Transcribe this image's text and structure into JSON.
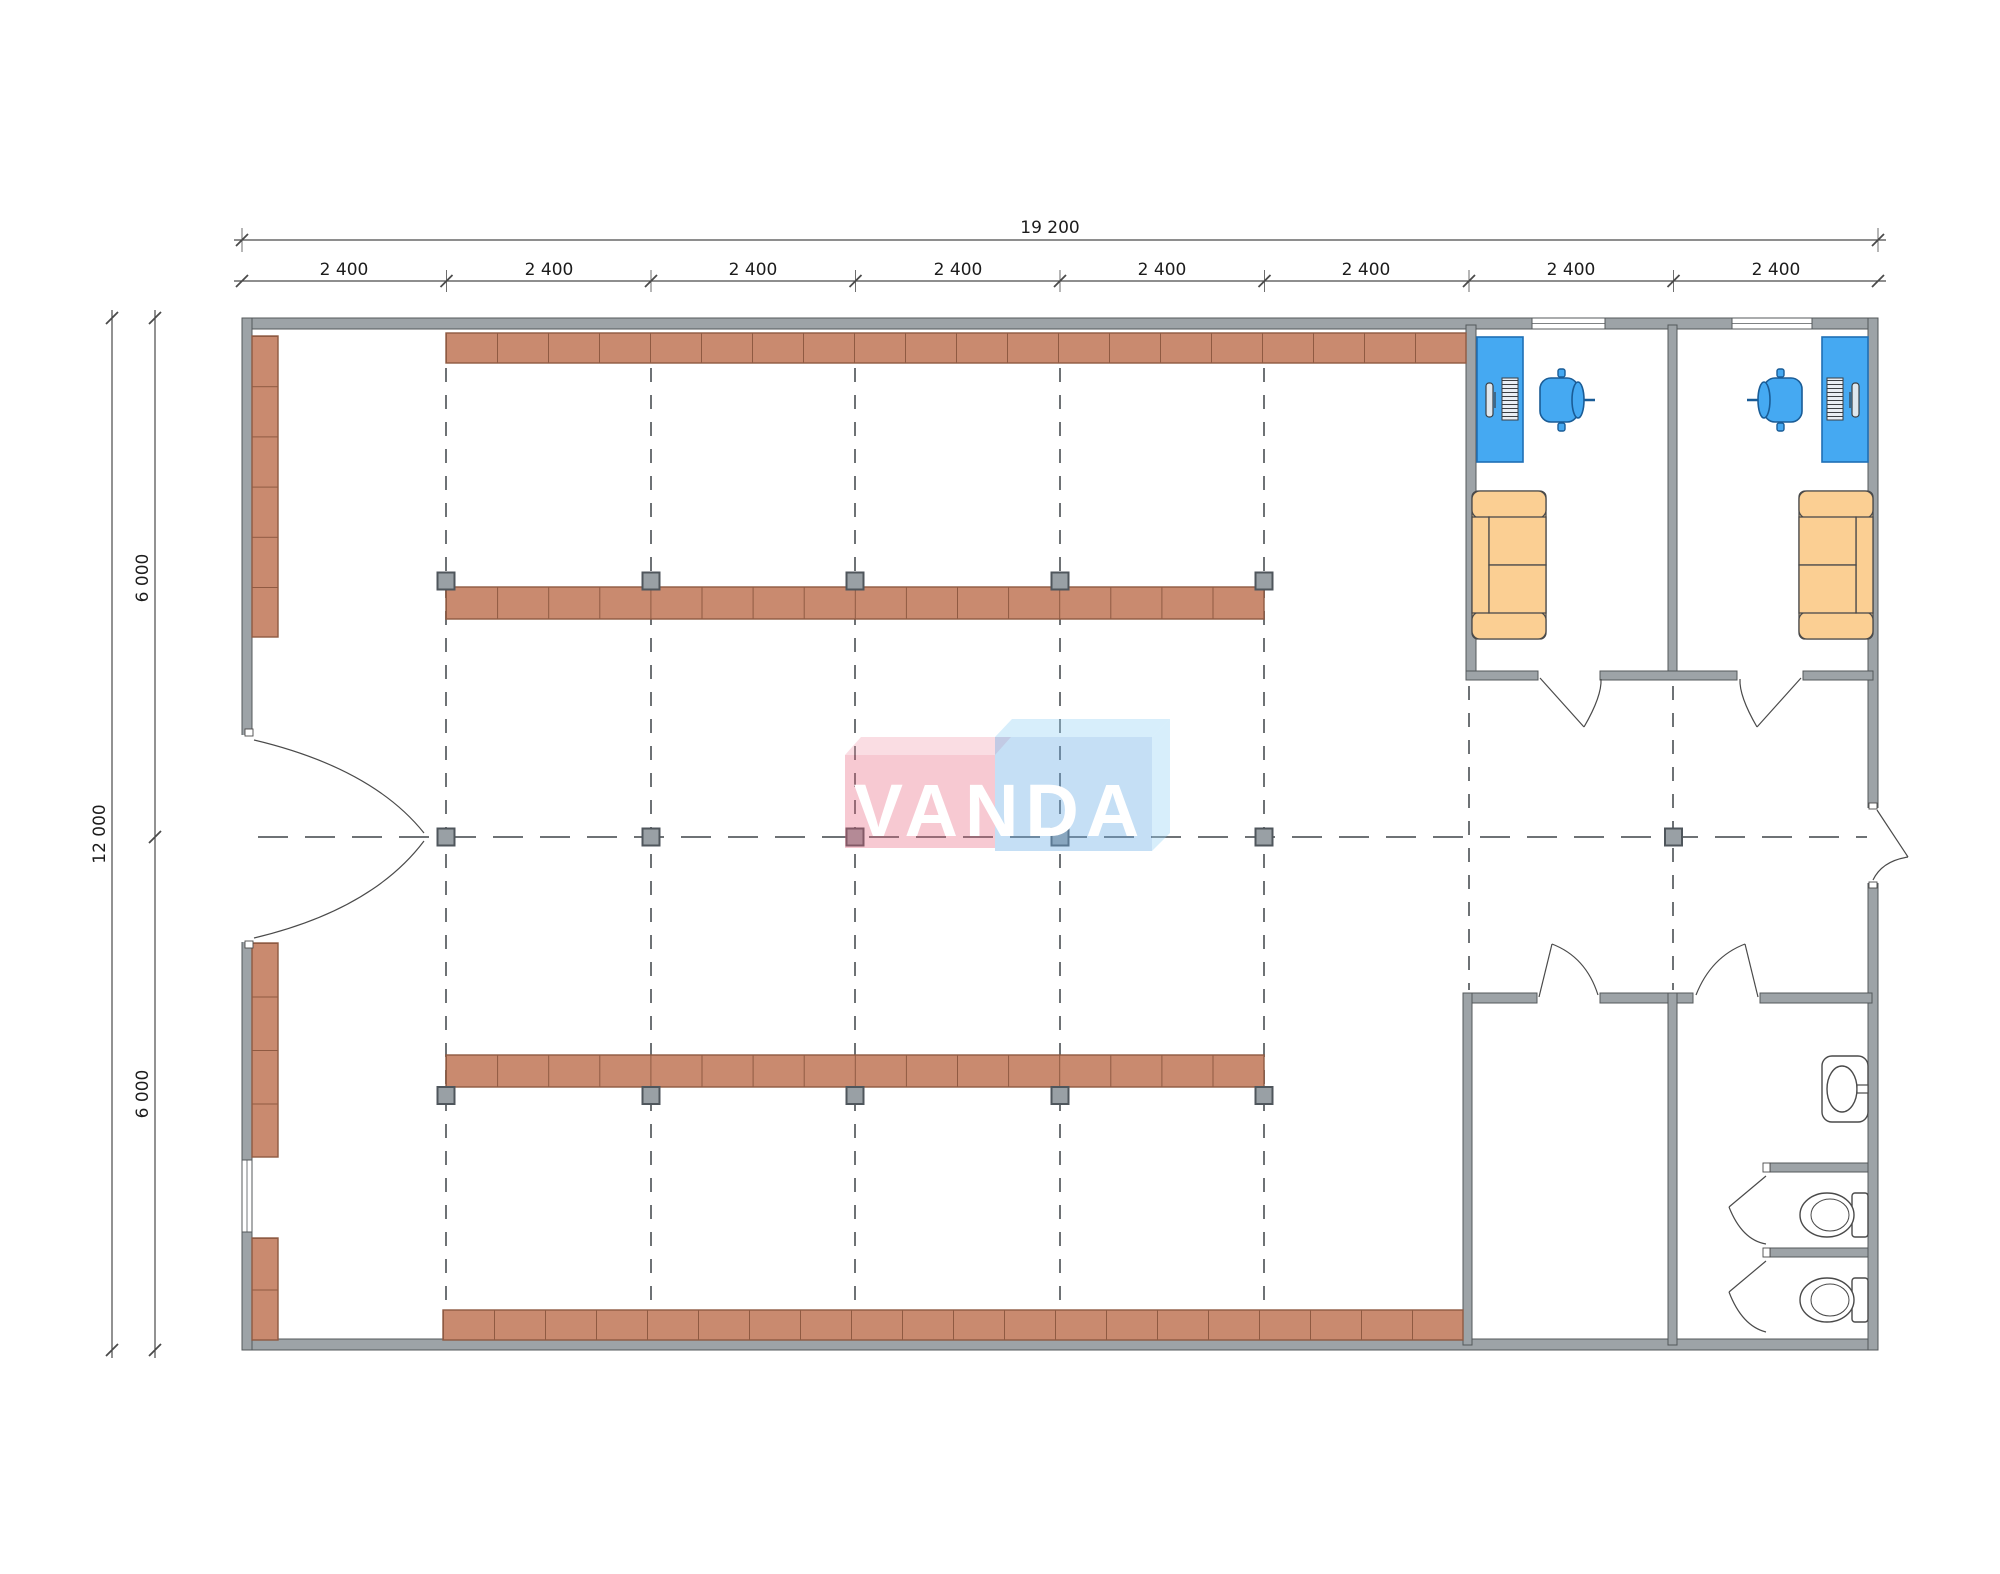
{
  "drawing": {
    "type": "floor-plan",
    "units": "mm"
  },
  "dimensions": {
    "total_width": "19 200",
    "total_height": "12 000",
    "top_bays": [
      "2 400",
      "2 400",
      "2 400",
      "2 400",
      "2 400",
      "2 400",
      "2 400",
      "2 400"
    ],
    "left_halves": [
      "6 000",
      "6 000"
    ]
  },
  "watermark": {
    "text": "VANDA"
  },
  "colors": {
    "wall_fill": "#9da3a7",
    "wall_stroke": "#54585b",
    "shelf_fill": "#c98a6f",
    "shelf_stroke": "#8f5a42",
    "desk_fill": "#45a9f2",
    "desk_stroke": "#1f6fb5",
    "chair_fill": "#45a9f2",
    "sofa_fill": "#fbcf93",
    "sofa_stroke": "#4a4a4a",
    "marker_fill": "#99a0a5",
    "marker_stroke": "#4f565c",
    "dash_line": "#6e7275",
    "dim_line": "#4a4a4a",
    "logo_pink": "rgba(231,98,122,0.34)",
    "logo_pink_top": "rgba(240,150,168,0.32)",
    "logo_blue": "rgba(110,175,230,0.40)",
    "logo_blue_top": "rgba(150,210,245,0.38)"
  }
}
